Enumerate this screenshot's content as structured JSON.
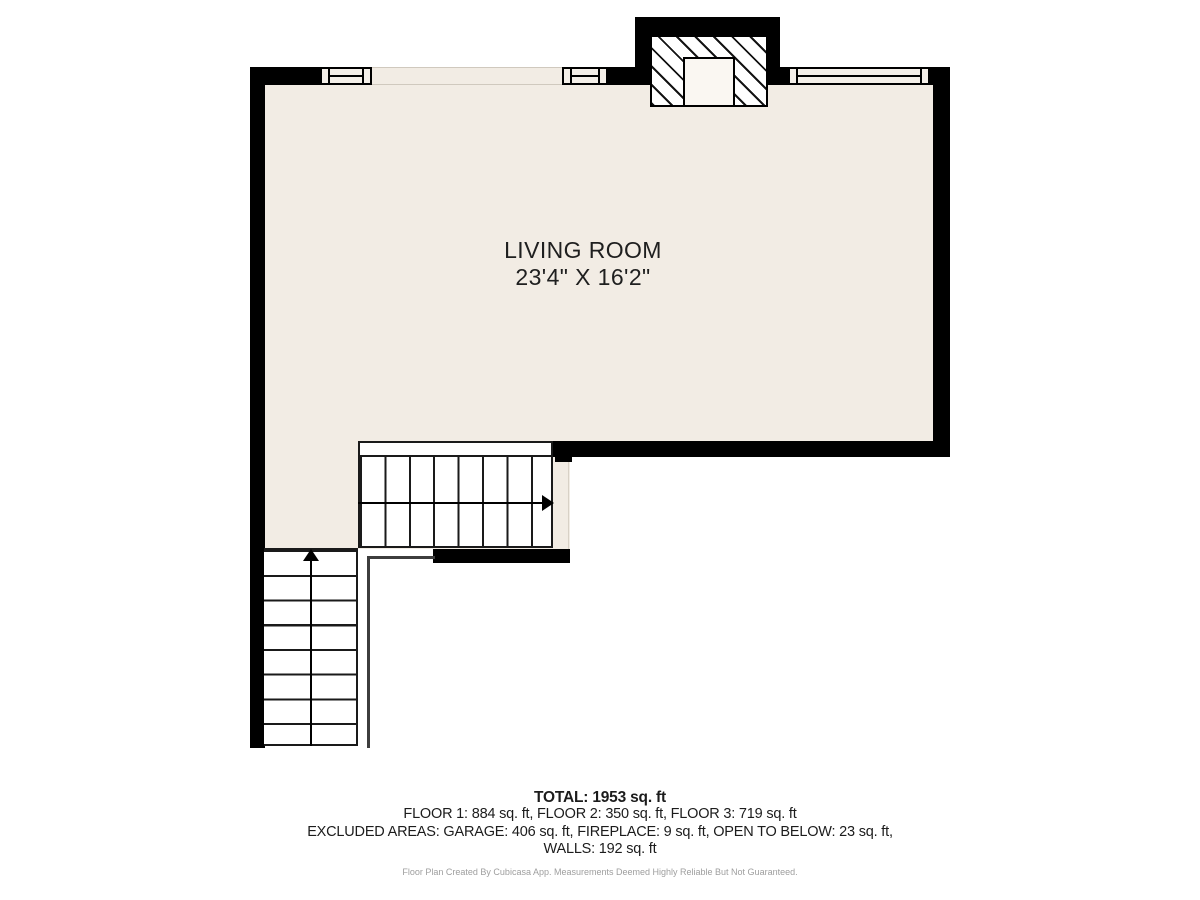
{
  "room": {
    "name": "LIVING ROOM",
    "dims": "23'4\" X 16'2\""
  },
  "summary": {
    "total": "TOTAL: 1953 sq. ft",
    "floors": "FLOOR 1: 884 sq. ft, FLOOR 2: 350 sq. ft, FLOOR 3: 719 sq. ft",
    "excluded": "EXCLUDED AREAS: GARAGE: 406 sq. ft, FIREPLACE: 9 sq. ft, OPEN TO BELOW: 23 sq. ft,",
    "walls": "WALLS: 192 sq. ft",
    "disclaimer": "Floor Plan Created By Cubicasa App. Measurements Deemed Highly Reliable But Not Guaranteed."
  },
  "icons": {
    "stairs_up_arrow": "arrow-up",
    "stairs_right_arrow": "arrow-right"
  },
  "colors": {
    "wall": "#000000",
    "floor": "#f2ece4",
    "background": "#ffffff",
    "stair_line": "#1a1a1a",
    "light_line": "#d0c9be",
    "text": "#1f1f1f",
    "muted_text": "#9e9e9e"
  }
}
